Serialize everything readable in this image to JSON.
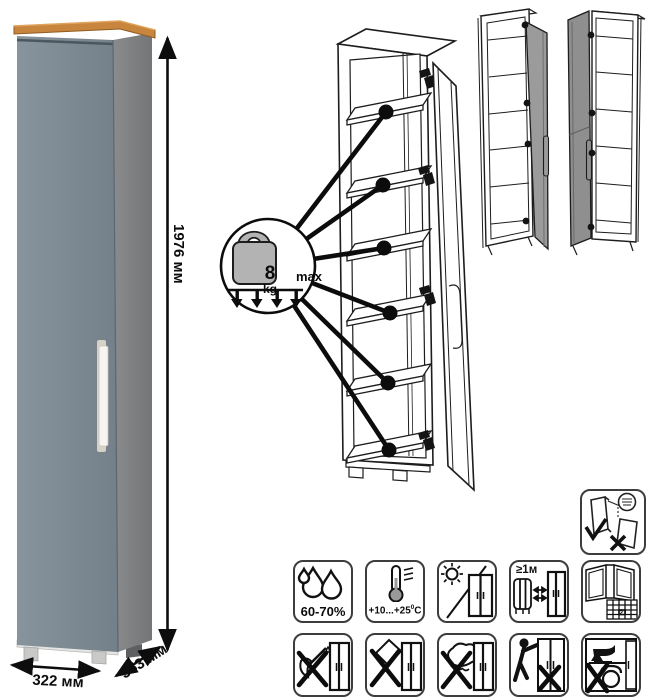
{
  "product": {
    "kind": "tall-single-door-cabinet",
    "dimensions": {
      "height": "1976 мм",
      "width": "322 мм",
      "depth": "353 мм"
    }
  },
  "load_callout": {
    "weight": "8",
    "unit": "kg",
    "qualifier": "max",
    "shelf_count": 6
  },
  "care_icons": {
    "humidity": "60-70%",
    "temperature": {
      "range": "+10...+25",
      "degree_sign": "0",
      "unit": "C"
    },
    "heat_distance": "≥1м",
    "acclimatization_day": "21"
  },
  "colors": {
    "wood_top": "#c8853d",
    "front_panel": "#7e8b94",
    "side_panel": "#7f8184",
    "door_gray": "#9b9b9b",
    "line_art": "#1d1d1d"
  }
}
